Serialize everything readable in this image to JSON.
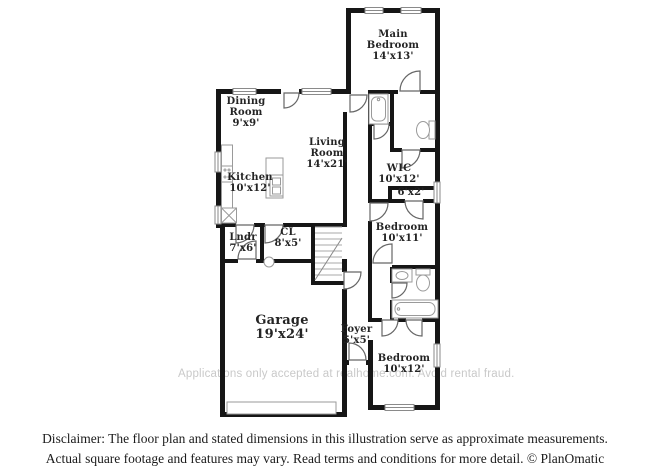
{
  "watermark": "Applications only accepted at realhome.com. Avoid rental fraud.",
  "rooms": {
    "main_bedroom": {
      "name": "Main Bedroom",
      "dims": "14'x13'"
    },
    "dining": {
      "name": "Dining Room",
      "dims": "9'x9'"
    },
    "living": {
      "name": "Living Room",
      "dims": "14'x21'"
    },
    "kitchen": {
      "name": "Kitchen",
      "dims": "10'x12'"
    },
    "wic": {
      "name": "WIC",
      "dims": "10'x12'"
    },
    "closet": {
      "name": "",
      "dims": "6'x2'"
    },
    "bedroom_mid": {
      "name": "Bedroom",
      "dims": "10'x11'"
    },
    "laundry": {
      "name": "Lndr",
      "dims": "7'x6'"
    },
    "cl": {
      "name": "CL",
      "dims": "8'x5'"
    },
    "garage": {
      "name": "Garage",
      "dims": "19'x24'"
    },
    "foyer": {
      "name": "Foyer",
      "dims": "5'x5'"
    },
    "bedroom_bottom": {
      "name": "Bedroom",
      "dims": "10'x12'"
    }
  },
  "disclaimer": {
    "line1": "Disclaimer: The floor plan and stated dimensions in this illustration serve as approximate measurements.",
    "line2": "Actual square footage and features may vary. Read terms and conditions for more detail. © PlanOmatic"
  },
  "colors": {
    "wall": "#161616",
    "fixture": "#9a9a9a",
    "door": "#666666",
    "label": "#242424",
    "watermark": "#c9c9c9"
  }
}
